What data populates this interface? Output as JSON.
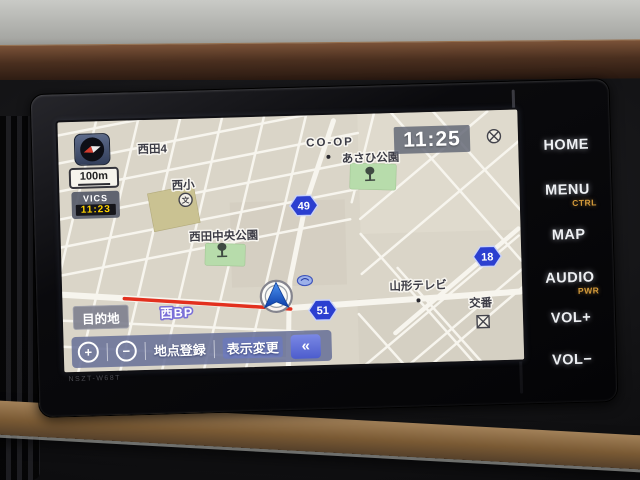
{
  "device": {
    "model_label": "NSZT-W68T",
    "buttons": [
      {
        "label": "HOME",
        "sub": ""
      },
      {
        "label": "MENU",
        "sub": "CTRL"
      },
      {
        "label": "MAP",
        "sub": ""
      },
      {
        "label": "AUDIO",
        "sub": "PWR"
      },
      {
        "label": "VOL+",
        "sub": ""
      },
      {
        "label": "VOL−",
        "sub": ""
      }
    ]
  },
  "nav": {
    "clock": "11:25",
    "scale": "100m",
    "vics": {
      "label": "VICS",
      "time": "11:23"
    },
    "destination_button": "目的地",
    "road_name": "西BP",
    "toolbar": {
      "zoom_in": "+",
      "zoom_out": "−",
      "register_point": "地点登録",
      "change_display": "表示変更",
      "collapse": "«"
    },
    "map": {
      "labels": {
        "district": "西田4",
        "coop": "CO-OP",
        "asahi_park": "あさひ公園",
        "nishi_elementary": "西小",
        "school_mark": "文",
        "chuo_park": "西田中央公園",
        "yamagata_tv": "山形テレビ",
        "koban": "交番"
      },
      "route_badges": [
        {
          "number": "49"
        },
        {
          "number": "18"
        },
        {
          "number": "51"
        }
      ],
      "colors": {
        "badge_blue": "#2b3fd0",
        "congestion_red": "#e2301e",
        "park_green": "#b7dcab",
        "school_khaki": "#cac292",
        "map_bg": "#dad5c8",
        "road_white": "#f7f5ee",
        "vics_time_yellow": "#ffd400",
        "button_sub_amber": "#d49a3a"
      }
    }
  }
}
